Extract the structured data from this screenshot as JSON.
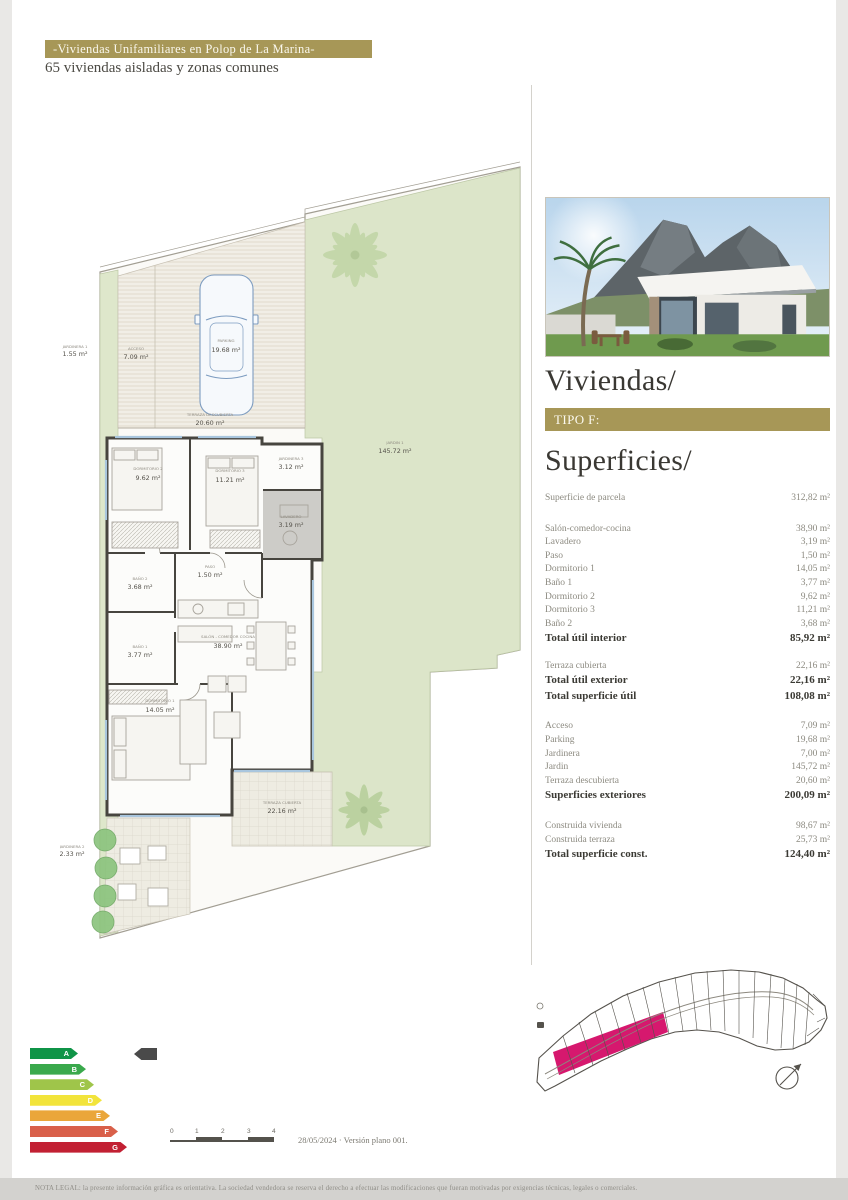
{
  "header": {
    "title": "-Viviendas Unifamiliares en Polop de La Marina-",
    "subtitle": "65 viviendas aisladas y zonas comunes",
    "accent_color": "#a79757"
  },
  "panel": {
    "viviendas_title": "Viviendas/",
    "tipo_label": "TIPO F:",
    "superficies_title": "Superficies/",
    "parcela": {
      "label": "Superficie de parcela",
      "value": "312,82 m²"
    },
    "interior_rows": [
      {
        "label": "Salón-comedor-cocina",
        "value": "38,90 m²"
      },
      {
        "label": "Lavadero",
        "value": "3,19 m²"
      },
      {
        "label": "Paso",
        "value": "1,50 m²"
      },
      {
        "label": "Dormitorio 1",
        "value": "14,05 m²"
      },
      {
        "label": "Baño 1",
        "value": "3,77 m²"
      },
      {
        "label": "Dormitorio 2",
        "value": "9,62 m²"
      },
      {
        "label": "Dormitorio 3",
        "value": "11,21 m²"
      },
      {
        "label": "Baño 2",
        "value": "3,68 m²"
      }
    ],
    "interior_total": {
      "label": "Total útil interior",
      "value": "85,92 m²"
    },
    "exterior_rows": [
      {
        "label": "Terraza cubierta",
        "value": "22,16 m²"
      }
    ],
    "exterior_total": {
      "label": "Total útil exterior",
      "value": "22,16 m²"
    },
    "util_total": {
      "label": "Total superficie útil",
      "value": "108,08 m²"
    },
    "outdoor_rows": [
      {
        "label": "Acceso",
        "value": "7,09 m²"
      },
      {
        "label": "Parking",
        "value": "19,68 m²"
      },
      {
        "label": "Jardinera",
        "value": "7,00 m²"
      },
      {
        "label": "Jardin",
        "value": "145,72 m²"
      },
      {
        "label": "Terraza descubierta",
        "value": "20,60 m²"
      }
    ],
    "outdoor_total": {
      "label": "Superficies exteriores",
      "value": "200,09 m²"
    },
    "built_rows": [
      {
        "label": "Construida vivienda",
        "value": "98,67 m²"
      },
      {
        "label": "Construida terraza",
        "value": "25,73 m²"
      }
    ],
    "built_total": {
      "label": "Total superficie const.",
      "value": "124,40 m²"
    }
  },
  "plan": {
    "rooms": [
      {
        "name": "JARDINERA 1",
        "area": "1.55 m²"
      },
      {
        "name": "ACCESO",
        "area": "7.09 m²"
      },
      {
        "name": "PARKING",
        "area": "19.68 m²"
      },
      {
        "name": "TERRAZA DESCUBIERTA",
        "area": "20.60 m²"
      },
      {
        "name": "JARDIN 1",
        "area": "145.72 m²"
      },
      {
        "name": "JARDINERA 3",
        "area": "3.12 m²"
      },
      {
        "name": "LAVADERO",
        "area": "3.19 m²"
      },
      {
        "name": "DORMITORIO 2",
        "area": "9.62 m²"
      },
      {
        "name": "DORMITORIO 3",
        "area": "11.21 m²"
      },
      {
        "name": "PASO",
        "area": "1.50 m²"
      },
      {
        "name": "BAÑO 2",
        "area": "3.68 m²"
      },
      {
        "name": "BAÑO 1",
        "area": "3.77 m²"
      },
      {
        "name": "DORMITORIO 1",
        "area": "14.05 m²"
      },
      {
        "name": "SALÓN - COMEDOR COCINA",
        "area": "38.90 m²"
      },
      {
        "name": "TERRAZA CUBIERTA",
        "area": "22.16 m²"
      },
      {
        "name": "JARDINERA 2",
        "area": "2.33 m²"
      }
    ]
  },
  "energy": {
    "ratings": [
      {
        "letter": "A",
        "color": "#0f9447"
      },
      {
        "letter": "B",
        "color": "#3aa94c"
      },
      {
        "letter": "C",
        "color": "#9fc54a"
      },
      {
        "letter": "D",
        "color": "#f2e43b"
      },
      {
        "letter": "E",
        "color": "#eaa63a"
      },
      {
        "letter": "F",
        "color": "#d9604a"
      },
      {
        "letter": "G",
        "color": "#c22033"
      }
    ],
    "pointer_color": "#4a4a4a"
  },
  "siteplan": {
    "highlight_color": "#d6186e"
  },
  "scalebar": {
    "ticks": [
      "0",
      "1",
      "2",
      "3",
      "4"
    ]
  },
  "footer": {
    "version": "28/05/2024 · Versión plano 001.",
    "legal": "NOTA LEGAL: la presente información gráfica es orientativa. La sociedad vendedora se reserva el derecho a efectuar las modificaciones que fueran motivadas por exigencias técnicas, legales o comerciales."
  }
}
